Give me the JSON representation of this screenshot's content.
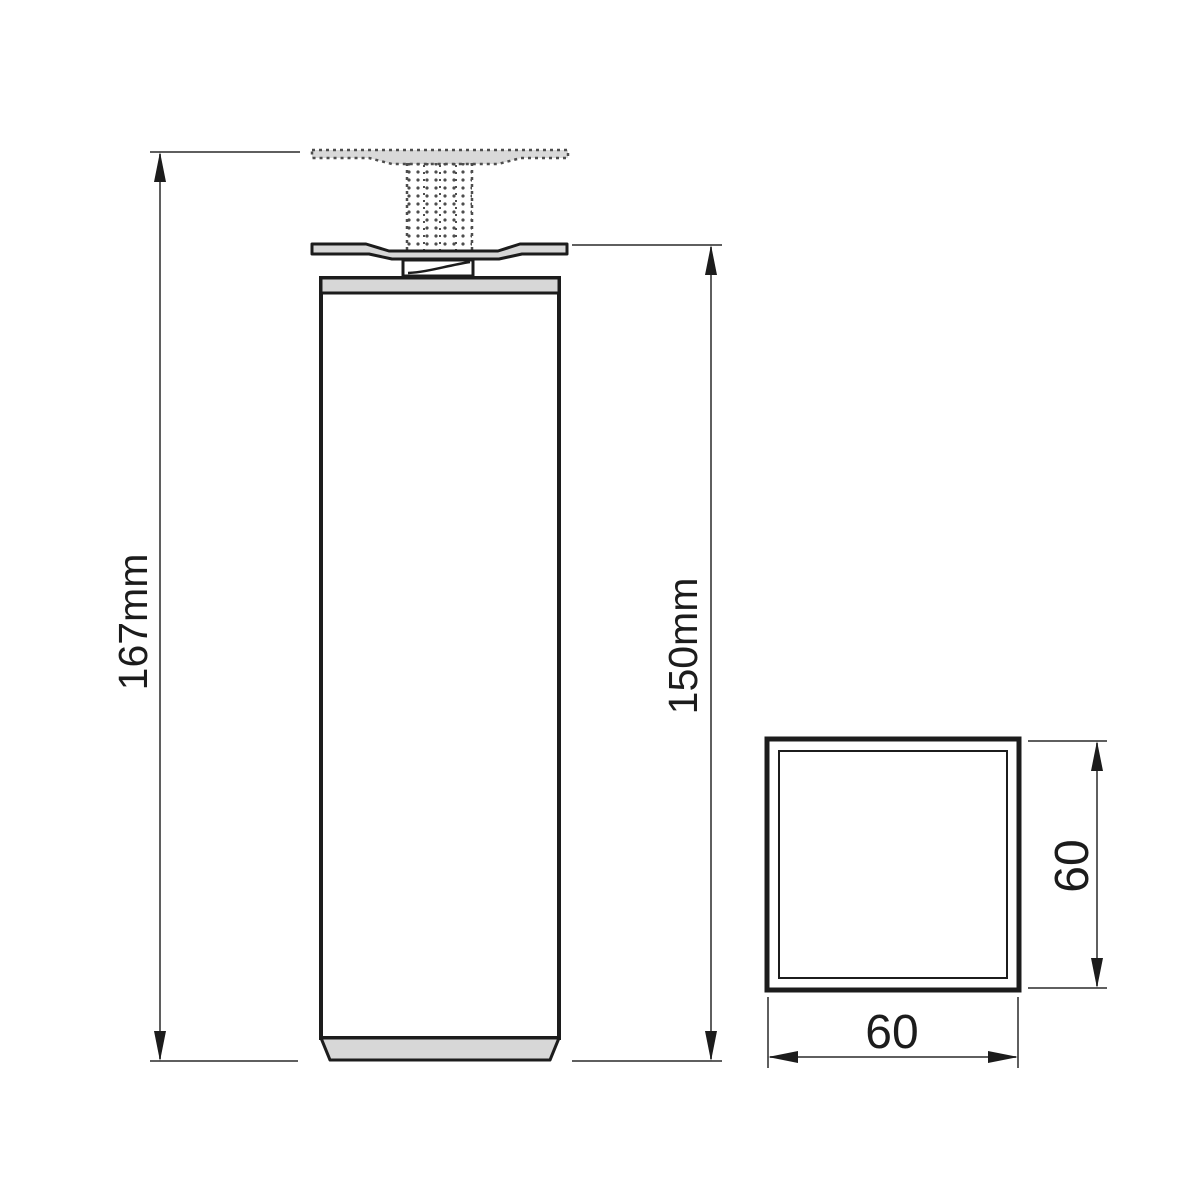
{
  "drawing": {
    "type": "technical-dimension-drawing",
    "subject": "square-furniture-leg",
    "labels": {
      "total_height": "167mm",
      "leg_height": "150mm",
      "section_height": "60",
      "section_width": "60"
    },
    "dimensions_mm": {
      "total_height": 167,
      "leg_height": 150,
      "section_width": 60,
      "section_height": 60
    },
    "colors": {
      "outline": "#1c1c1c",
      "metal_fill": "#d7d7d7",
      "dimension_line": "#5f5f5f",
      "phantom_dots": "#4d4d4d",
      "background": "#ffffff"
    }
  }
}
